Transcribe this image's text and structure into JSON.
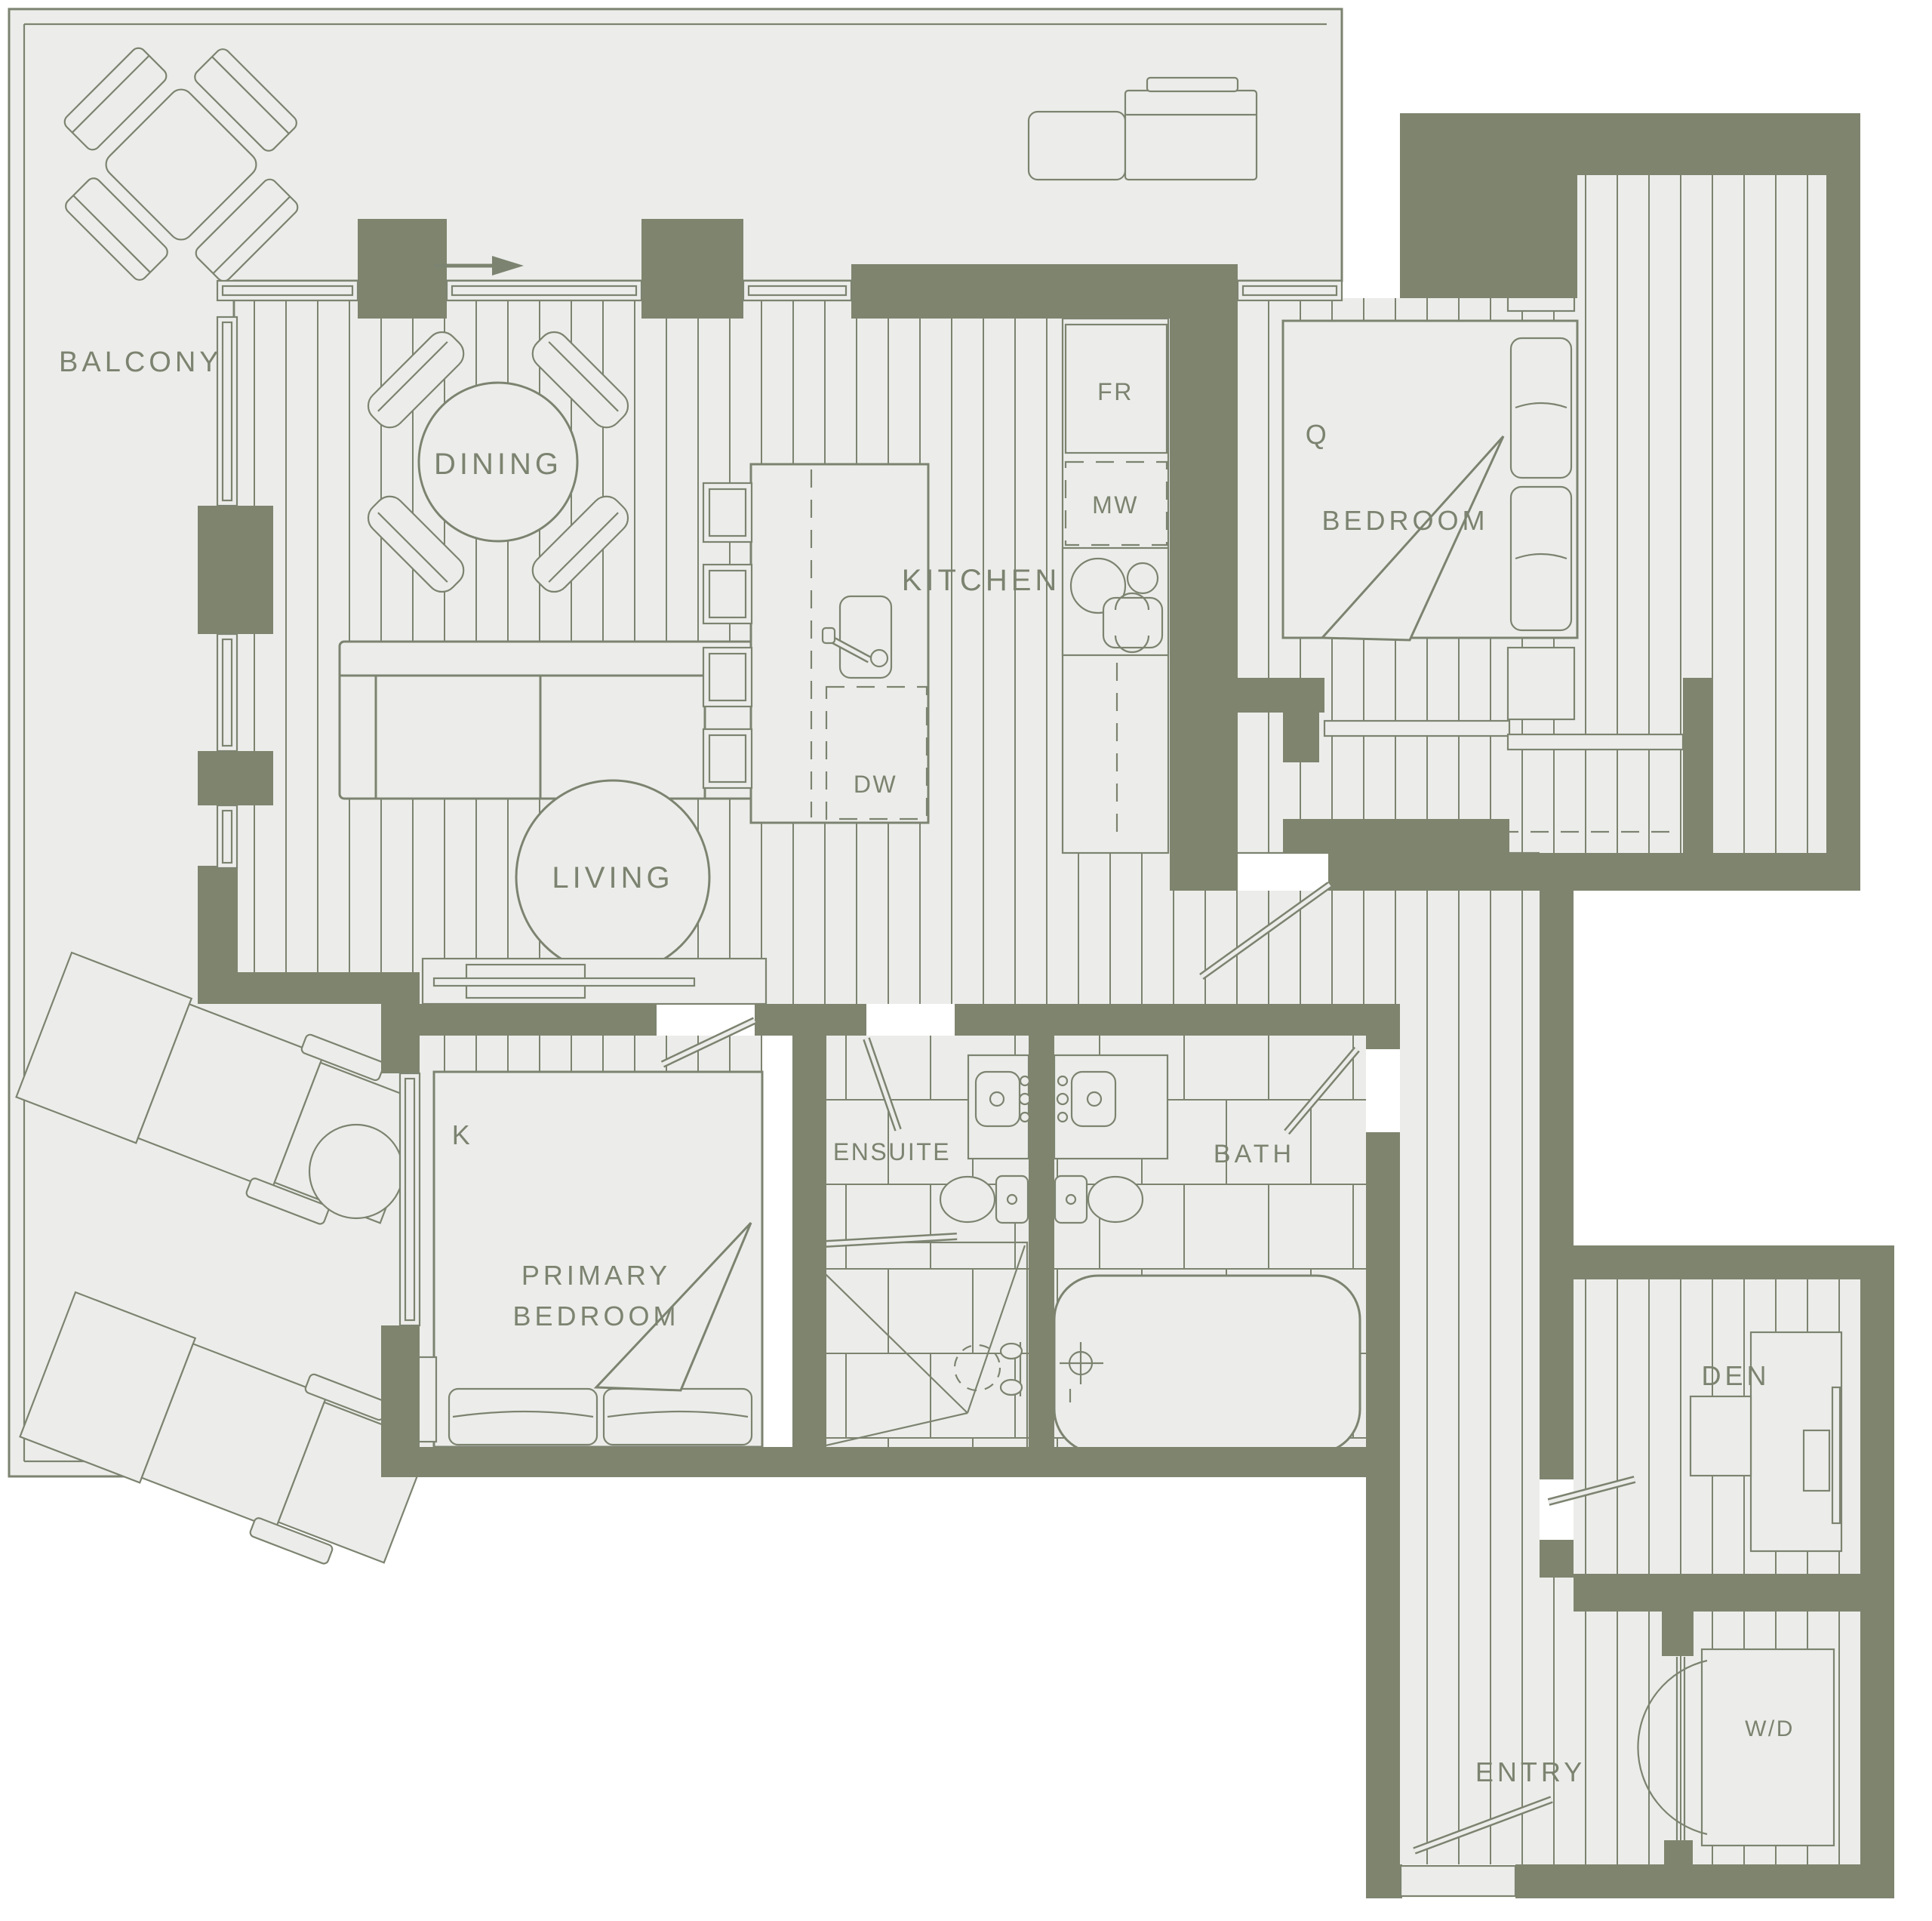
{
  "theme": {
    "wall": "#7E846E",
    "line": "#7C8370",
    "floor": "#ECEDEA",
    "bg": "#FFFFFF"
  },
  "plan": {
    "rooms": {
      "balcony": "BALCONY",
      "dining": "DINING",
      "living": "LIVING",
      "kitchen": "KITCHEN",
      "bedroom": "BEDROOM",
      "bedroom_bed_size": "Q",
      "primary_bedroom_line1": "PRIMARY",
      "primary_bedroom_line2": "BEDROOM",
      "primary_bed_size": "K",
      "ensuite": "ENSUITE",
      "bath": "BATH",
      "den": "DEN",
      "entry": "ENTRY"
    },
    "appliances": {
      "fridge": "FR",
      "microwave": "MW",
      "dishwasher": "DW",
      "washer_dryer": "W/D"
    }
  }
}
